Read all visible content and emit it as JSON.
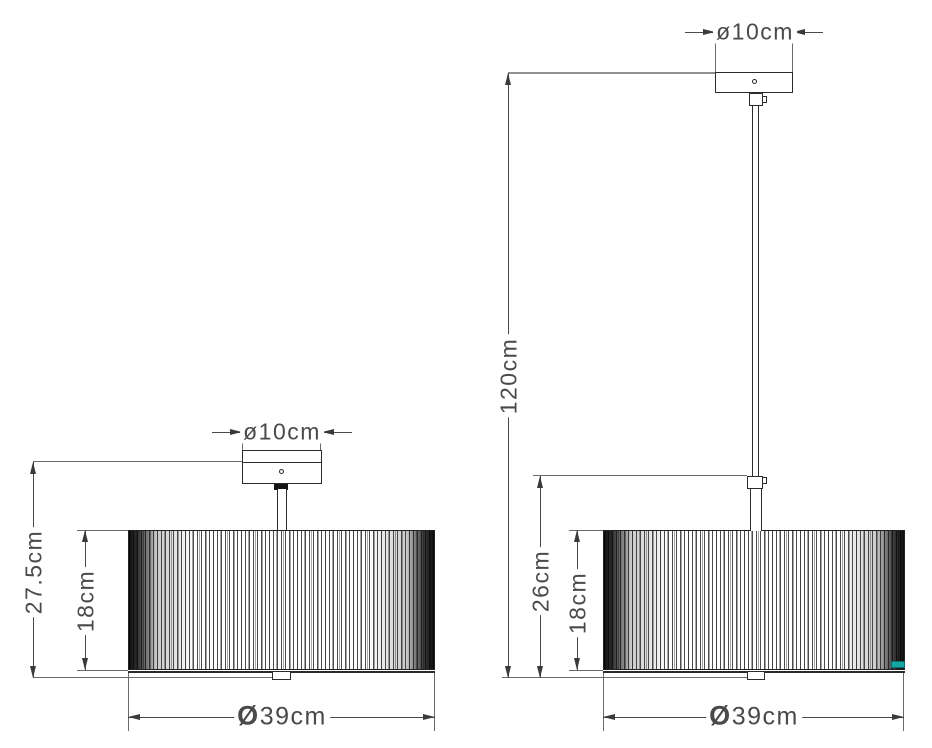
{
  "colors": {
    "object_line": "#2b2b2b",
    "dimension_line": "#4a4a4a",
    "ceiling_reference_line": "#909090",
    "shade_tag": "#14a7a1"
  },
  "left_lamp": {
    "canopy_diameter_label": "ø10cm",
    "overall_height_label": "27.5cm",
    "shade_height_label": "18cm",
    "shade_diameter_symbol": "Ø",
    "shade_diameter_value": "39cm"
  },
  "right_lamp": {
    "canopy_diameter_label": "ø10cm",
    "suspension_height_label": "120cm",
    "body_height_label": "26cm",
    "shade_height_label": "18cm",
    "shade_diameter_symbol": "Ø",
    "shade_diameter_value": "39cm"
  }
}
